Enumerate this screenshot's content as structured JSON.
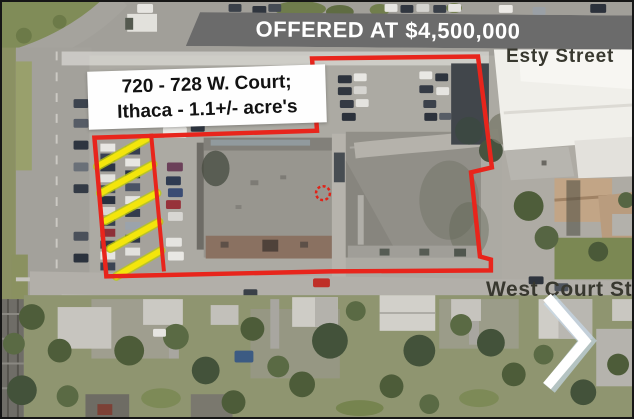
{
  "banner": {
    "text": "OFFERED AT $4,500,000",
    "bg_color": "#6b6b6b",
    "text_color": "#ffffff"
  },
  "property_label": {
    "line1": "720 - 728 W. Court;",
    "line2": "Ithaca - 1.1+/- acre's"
  },
  "street_labels": {
    "esty": "Esty Street",
    "west_court": "West Court St"
  },
  "annotations": {
    "boundary_color": "#e8251c",
    "hatch_color": "#f3e50c",
    "marker": "crosshair-circle",
    "hatch_stripe_count": 5
  },
  "nav": {
    "next_icon": "chevron-right"
  }
}
